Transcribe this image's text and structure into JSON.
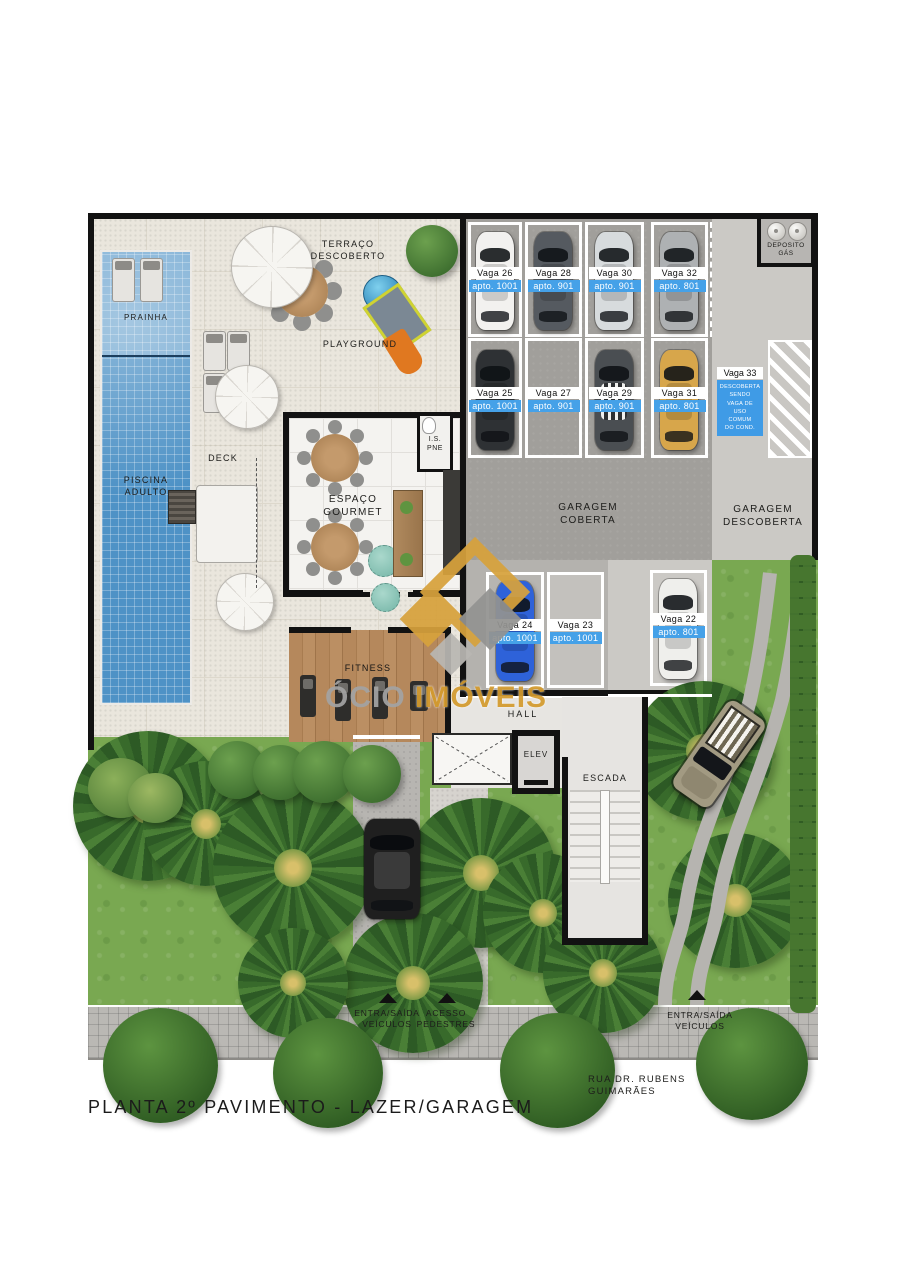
{
  "page": {
    "title": "PLANTA 2º PAVIMENTO - LAZER/GARAGEM",
    "street": "RUA DR. RUBENS GUIMARÃES"
  },
  "areas": {
    "terraco": "TERRAÇO\nDESCOBERTO",
    "playground": "PLAYGROUND",
    "prainha": "PRAINHA",
    "piscina_adulto": "PISCINA\nADULTO",
    "deck": "DECK",
    "espaco_gourmet": "ESPAÇO\nGOURMET",
    "is_pne": "I.S.\nPNE",
    "fitness": "FITNESS",
    "garagem_coberta": "GARAGEM\nCOBERTA",
    "garagem_descoberta": "GARAGEM\nDESCOBERTA",
    "deposito_gas": "DEPOSITO\nGÁS",
    "hall": "HALL",
    "elev": "ELEV",
    "escada": "ESCADA"
  },
  "access": {
    "veiculos_esq": "ENTRA/SAÍDA\nVEÍCULOS",
    "pedestres": "ACESSO\nPEDESTRES",
    "veiculos_dir": "ENTRA/SAÍDA\nVEÍCULOS"
  },
  "parking": {
    "spots": [
      {
        "vaga": "Vaga 26",
        "apto": "apto. 1001",
        "car_color": "#f2f1ef"
      },
      {
        "vaga": "Vaga 28",
        "apto": "apto. 901",
        "car_color": "#555a60"
      },
      {
        "vaga": "Vaga 30",
        "apto": "apto. 901",
        "car_color": "#d7dbdd"
      },
      {
        "vaga": "Vaga 32",
        "apto": "apto. 801",
        "car_color": "#aeb1b3"
      },
      {
        "vaga": "Vaga 25",
        "apto": "apto. 1001",
        "car_color": "#2e3134"
      },
      {
        "vaga": "Vaga 27",
        "apto": "apto. 901",
        "car_color": null
      },
      {
        "vaga": "Vaga 29",
        "apto": "apto. 901",
        "car_color": "#4a4e52"
      },
      {
        "vaga": "Vaga 31",
        "apto": "apto. 801",
        "car_color": "#d7a64b"
      },
      {
        "vaga": "Vaga 24",
        "apto": "apto. 1001",
        "car_color": "#2e62d9"
      },
      {
        "vaga": "Vaga 23",
        "apto": "apto. 1001",
        "car_color": null
      },
      {
        "vaga": "Vaga 22",
        "apto": "apto. 801",
        "car_color": "#efefec"
      }
    ],
    "vaga33": {
      "header": "Vaga 33",
      "body": "DESCOBERTA\nSENDO\nVAGA DE\nUSO\nCOMUM\nDO COND."
    }
  },
  "watermark": {
    "prefix": "ÓCIO",
    "brand": "IMÓVEIS"
  },
  "colors": {
    "apto_badge": "#45a1e8",
    "vaga33_sign": "#3f9be6",
    "watermark_gold": "#d49b2e",
    "pool": "#4e92c6",
    "grass": "#79a851"
  }
}
